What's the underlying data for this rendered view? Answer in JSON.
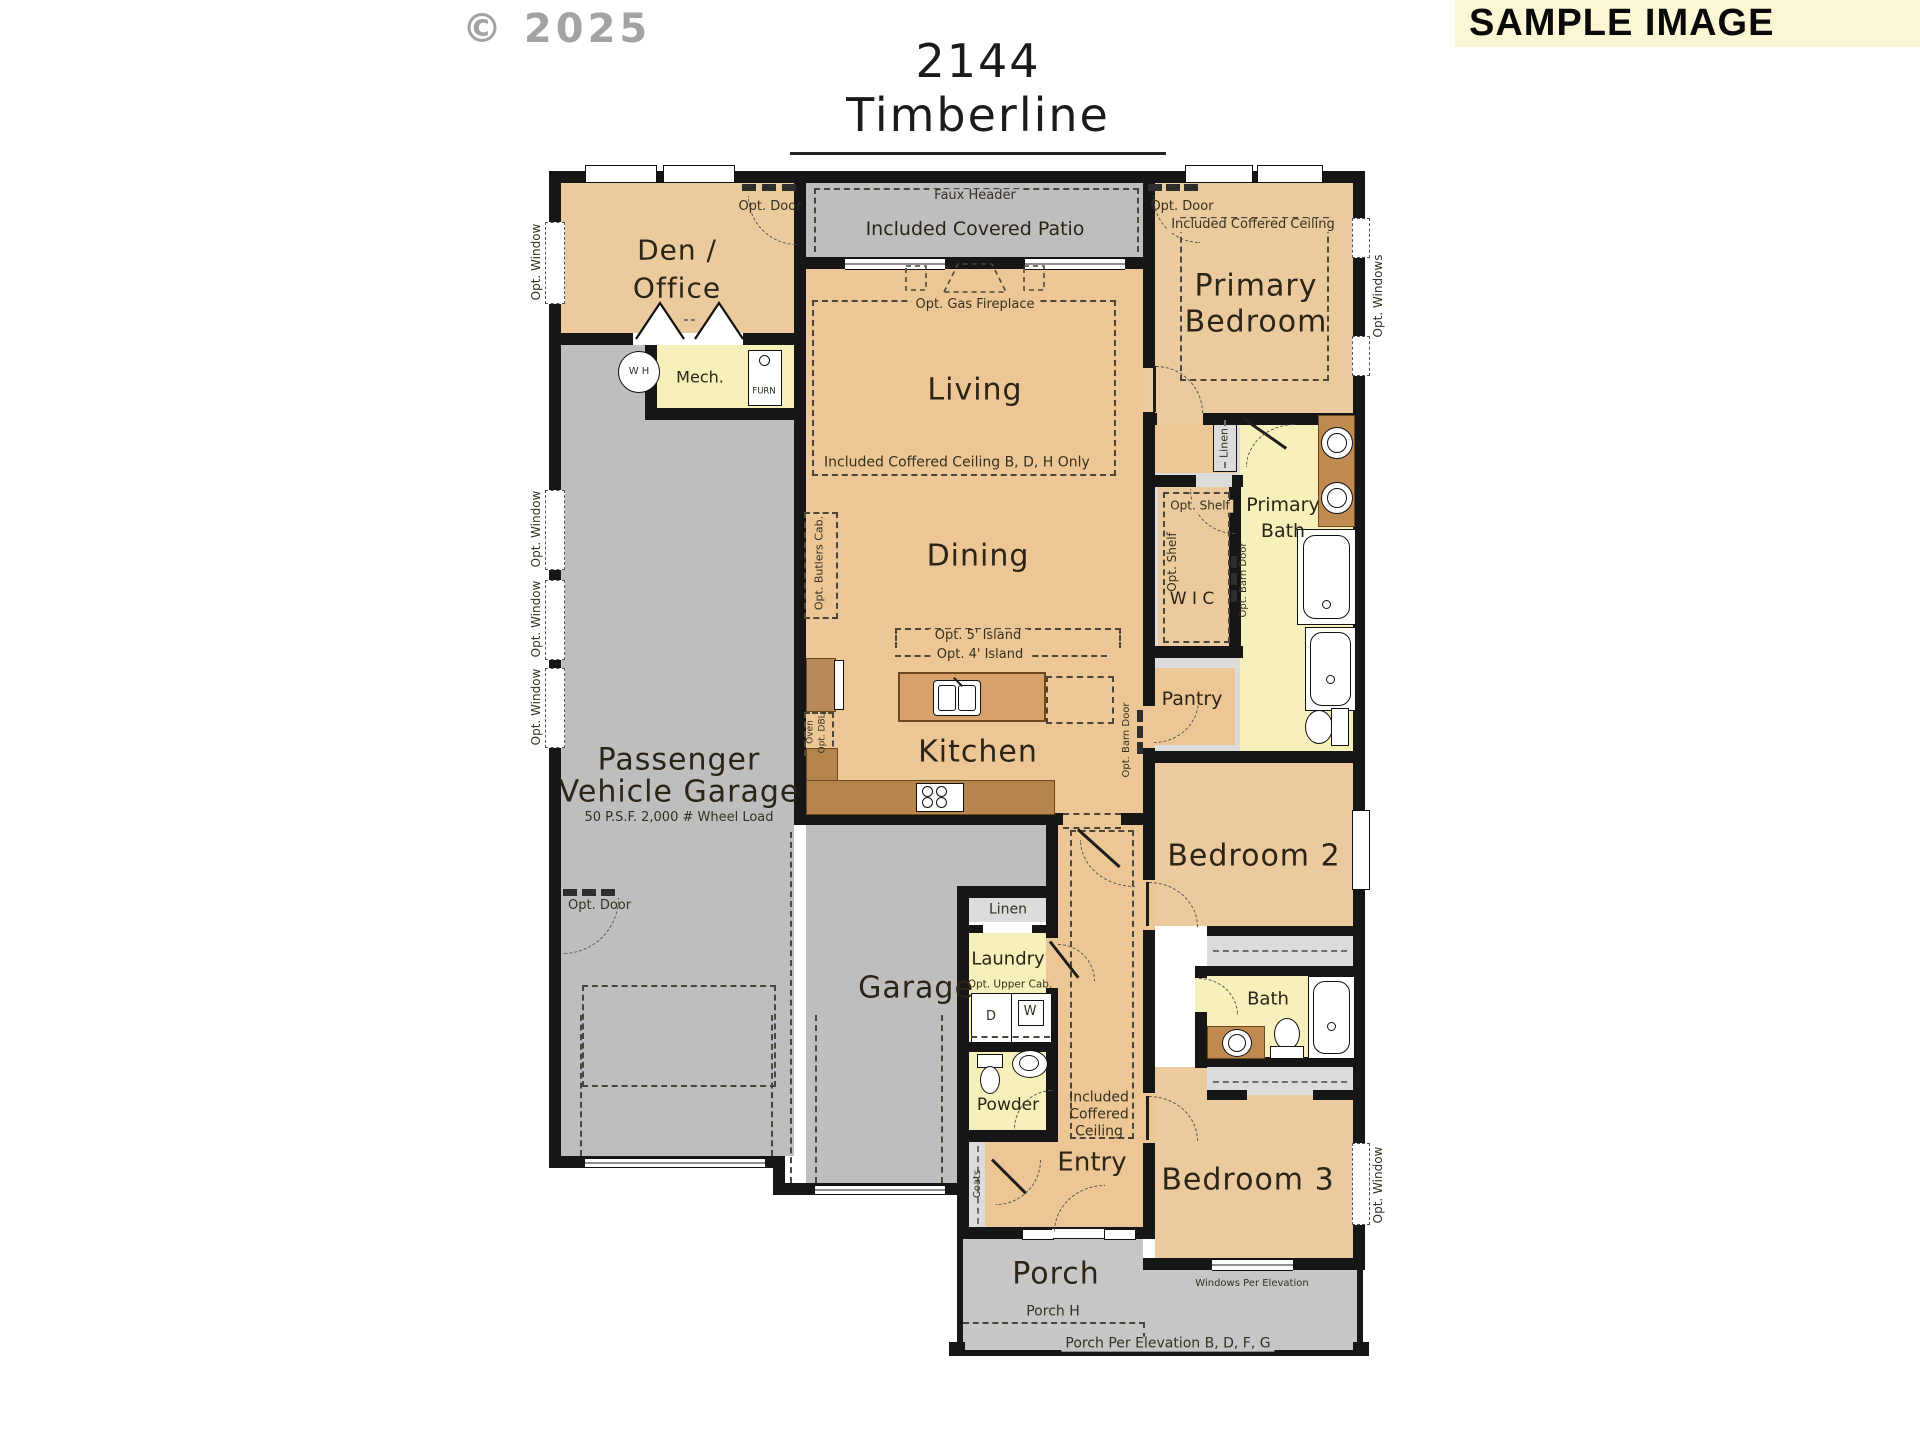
{
  "labels": {
    "copyright": "© 2025",
    "title": "2144 Timberline",
    "banner": "SAMPLE IMAGE",
    "den_1": "Den /",
    "den_2": "Office",
    "faux_header": "Faux Header",
    "covered_patio": "Included Covered Patio",
    "primary_1": "Primary",
    "primary_2": "Bedroom",
    "opt_door": "Opt. Door",
    "opt_window": "Opt. Window",
    "opt_windows": "Opt. Windows",
    "coffered_primary": "Included  Coffered Ceiling",
    "living": "Living",
    "gas_fireplace": "Opt. Gas Fireplace",
    "coffered_living": "Included  Coffered Ceiling B, D, H Only",
    "dining": "Dining",
    "butlers_cab": "Opt. Butlers Cab.",
    "island_5": "Opt. 5'  Island",
    "island_4": "Opt. 4'  Island",
    "kitchen": "Kitchen",
    "oven": "Oven",
    "opt_dbl": "Opt. DBL.",
    "opt_barn_door": "Opt. Barn Door",
    "pantry": "Pantry",
    "wic": "W I C",
    "opt_shelf": "Opt. Shelf",
    "linen": "Linen",
    "primary_bath_1": "Primary",
    "primary_bath_2": "Bath",
    "wh": "W H",
    "mech": "Mech.",
    "furn": "FURN",
    "garage_line_1": "Passenger",
    "garage_line_2": "Vehicle Garage",
    "garage_spec": "50 P.S.F. 2,000 #  Wheel Load",
    "garage": "Garage",
    "bedroom2": "Bedroom 2",
    "bedroom3": "Bedroom 3",
    "bath": "Bath",
    "coffered_hall_1": "Included",
    "coffered_hall_2": "Coffered",
    "coffered_hall_3": "Ceiling",
    "laundry": "Laundry",
    "opt_upper_cab": "Opt. Upper Cab.",
    "dryer": "D",
    "washer": "W",
    "powder": "Powder",
    "coats": "Coats",
    "entry": "Entry",
    "porch": "Porch",
    "porch_h": "Porch H",
    "porch_elevation": "Porch Per Elevation B, D, F, G",
    "windows_elevation": "Windows Per Elevation"
  },
  "colors": {
    "wall": "#161616",
    "room_tan": "#EBCB9E",
    "room_tan_warm": "#ECC795",
    "outdoor_gray": "#BEBEBE",
    "closet_gray": "#DCDCDC",
    "bath_yellow": "#F7F0BA",
    "counter_brown": "#B5854B",
    "island_brown": "#D7A269",
    "banner_bg": "#FBF7D5",
    "watermark_gray": "#A3A3A3"
  }
}
